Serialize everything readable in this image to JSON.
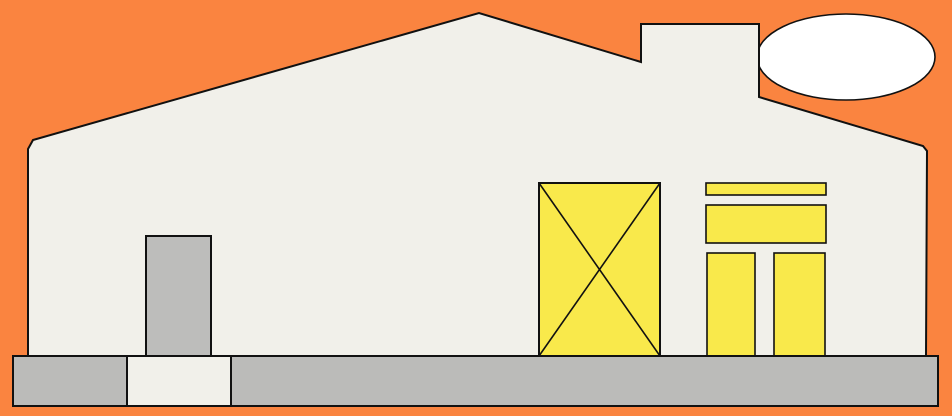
{
  "scene": {
    "title": "flat-house-illustration",
    "colors": {
      "background": "#fa8440",
      "wall": "#f1f0ea",
      "yellow": "#f9e94b",
      "door_gray": "#bdbdbb",
      "foundation_gray": "#bbbbb9",
      "smoke_white": "#ffffff",
      "outline": "#111111"
    },
    "elements": {
      "background": "sky-background",
      "smoke": "smoke-cloud",
      "house": "house-body-with-chimney",
      "door": "front-door",
      "crossed_window": "crossed-window",
      "transom_bar": "transom-top-bar",
      "transom_panel": "transom-panel",
      "panel_left": "double-door-left-panel",
      "panel_right": "double-door-right-panel",
      "foundation": "foundation-strip",
      "doorstep": "doorstep-segment"
    }
  }
}
